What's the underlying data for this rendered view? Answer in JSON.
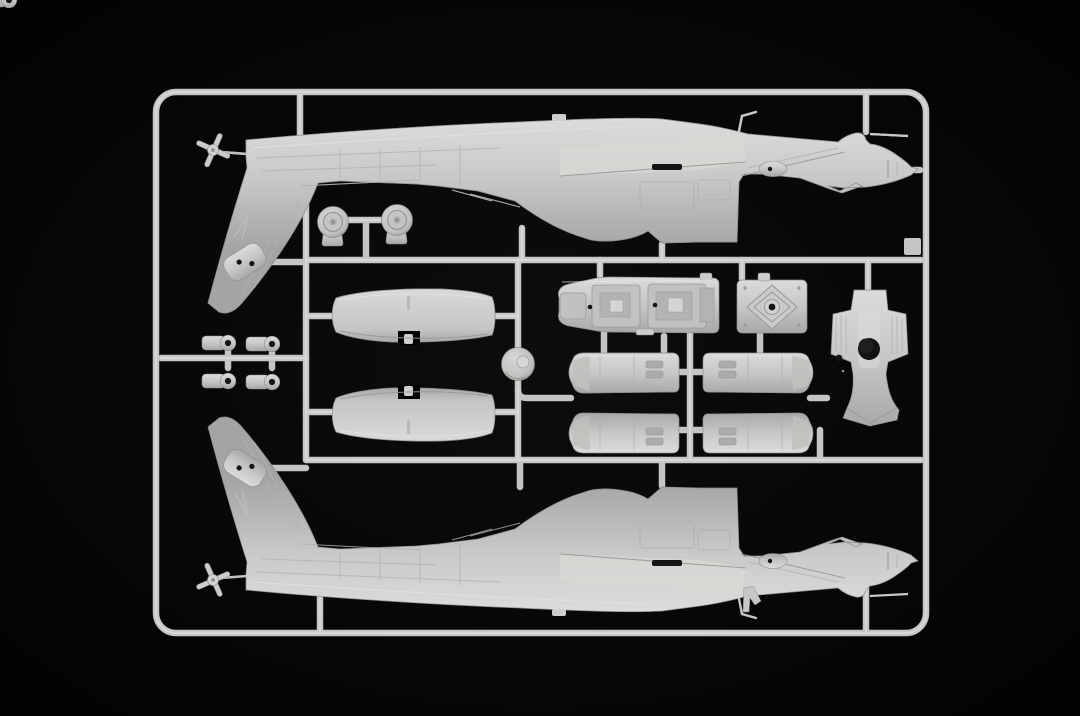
{
  "scene": {
    "description": "Photograph of an injection-moulded polystyrene model-kit sprue (runner frame) holding light grey parts of an AH-64 Apache attack helicopter kit, on a black background",
    "background_color": "#030303",
    "vignette_color": "#0d0d0d",
    "plastic": {
      "base": "#cdccca",
      "highlight": "#e4e3e1",
      "shadow": "#a8a7a5",
      "runner": "#c6c5c3",
      "runner_highlight": "#dcdbd9",
      "outline": "#8e8e8c",
      "recess": "#141414"
    },
    "sprue": {
      "frame_shape": "rounded-rectangle",
      "total_parts": 19,
      "parts": [
        {
          "name": "fuselage-half-upper",
          "description": "Helicopter fuselage half: tail boom at left with downward vertical fin and tail-rotor hub, stepped canopy and sensor nose with gun stub at right",
          "qty": 1,
          "position": "top"
        },
        {
          "name": "fuselage-half-lower",
          "description": "Opposite fuselage half, vertical mirror image of the upper one",
          "qty": 1,
          "position": "bottom"
        },
        {
          "name": "main-wheel",
          "description": "Main landing-gear wheel half with tyre and hub recess",
          "qty": 2,
          "position": "upper middle-left"
        },
        {
          "name": "stub-wing",
          "description": "Stub-wing panel with centre locating notch",
          "qty": 2,
          "position": "middle left"
        },
        {
          "name": "link-fitting",
          "description": "Small eyelet / trunnion fitting with bore",
          "qty": 4,
          "position": "far left cluster"
        },
        {
          "name": "rotor-head-disc",
          "description": "Round rotor-head base disc with centre boss",
          "qty": 1,
          "position": "centre"
        },
        {
          "name": "cockpit-tub",
          "description": "Tandem cockpit tub with two stepped bays and locating holes",
          "qty": 1,
          "position": "centre"
        },
        {
          "name": "transmission-plate",
          "description": "Square transmission / gearbox plate with diamond ridge and centre bore",
          "qty": 1,
          "position": "centre-right"
        },
        {
          "name": "rotor-mast-fairing",
          "description": "Main rotor mast fairing, ribbed shoulders, large round opening, flared skirt",
          "qty": 1,
          "position": "right"
        },
        {
          "name": "engine-nacelle-half",
          "description": "Engine nacelle half-shell with twin louvre slots",
          "qty": 4,
          "position": "centre 2x2 block"
        }
      ]
    }
  }
}
